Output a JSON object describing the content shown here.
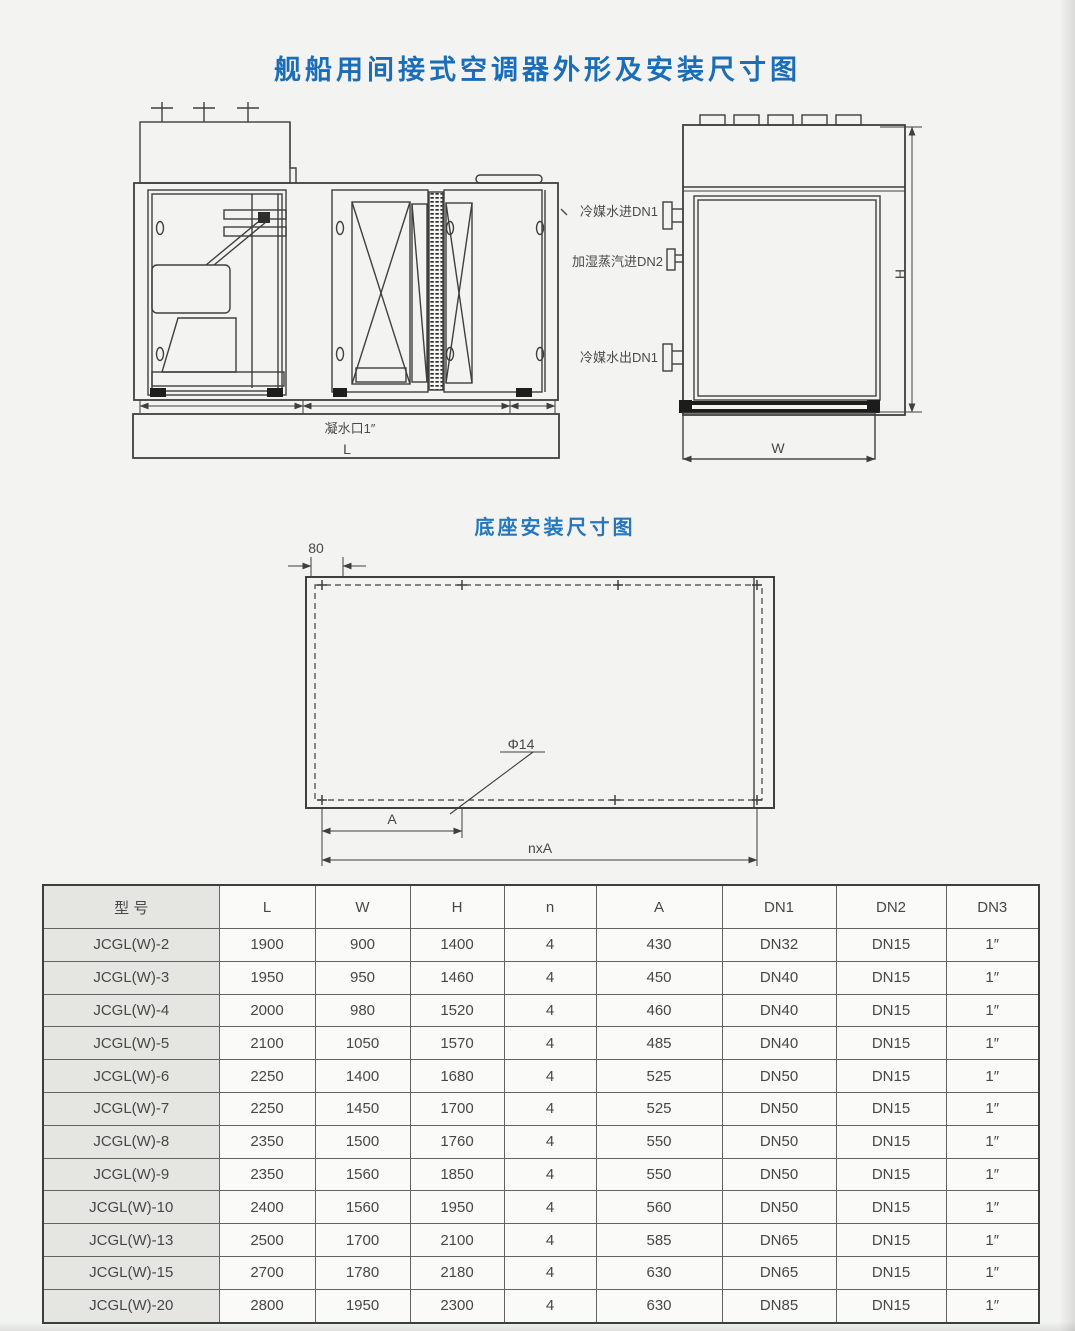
{
  "page": {
    "title": "舰船用间接式空调器外形及安装尺寸图",
    "base_section_title": "底座安装尺寸图"
  },
  "colors": {
    "title_blue": "#1a6db6",
    "line_gray": "#3f3f3f"
  },
  "front_view": {
    "drain_label": "凝水口1″",
    "dim_L": "L"
  },
  "pipes": {
    "chilled_water_in": "冷媒水进DN1",
    "steam_in": "加湿蒸汽进DN2",
    "chilled_water_out": "冷媒水出DN1"
  },
  "side_view": {
    "dim_H": "H",
    "dim_W": "W"
  },
  "base_view": {
    "dim_80": "80",
    "hole_callout": "Φ14",
    "dim_A": "A",
    "dim_nxA": "nxA"
  },
  "table": {
    "headers": [
      "型  号",
      "L",
      "W",
      "H",
      "n",
      "A",
      "DN1",
      "DN2",
      "DN3"
    ],
    "rows": [
      [
        "JCGL(W)-2",
        "1900",
        "900",
        "1400",
        "4",
        "430",
        "DN32",
        "DN15",
        "1″"
      ],
      [
        "JCGL(W)-3",
        "1950",
        "950",
        "1460",
        "4",
        "450",
        "DN40",
        "DN15",
        "1″"
      ],
      [
        "JCGL(W)-4",
        "2000",
        "980",
        "1520",
        "4",
        "460",
        "DN40",
        "DN15",
        "1″"
      ],
      [
        "JCGL(W)-5",
        "2100",
        "1050",
        "1570",
        "4",
        "485",
        "DN40",
        "DN15",
        "1″"
      ],
      [
        "JCGL(W)-6",
        "2250",
        "1400",
        "1680",
        "4",
        "525",
        "DN50",
        "DN15",
        "1″"
      ],
      [
        "JCGL(W)-7",
        "2250",
        "1450",
        "1700",
        "4",
        "525",
        "DN50",
        "DN15",
        "1″"
      ],
      [
        "JCGL(W)-8",
        "2350",
        "1500",
        "1760",
        "4",
        "550",
        "DN50",
        "DN15",
        "1″"
      ],
      [
        "JCGL(W)-9",
        "2350",
        "1560",
        "1850",
        "4",
        "550",
        "DN50",
        "DN15",
        "1″"
      ],
      [
        "JCGL(W)-10",
        "2400",
        "1560",
        "1950",
        "4",
        "560",
        "DN50",
        "DN15",
        "1″"
      ],
      [
        "JCGL(W)-13",
        "2500",
        "1700",
        "2100",
        "4",
        "585",
        "DN65",
        "DN15",
        "1″"
      ],
      [
        "JCGL(W)-15",
        "2700",
        "1780",
        "2180",
        "4",
        "630",
        "DN65",
        "DN15",
        "1″"
      ],
      [
        "JCGL(W)-20",
        "2800",
        "1950",
        "2300",
        "4",
        "630",
        "DN85",
        "DN15",
        "1″"
      ]
    ]
  }
}
